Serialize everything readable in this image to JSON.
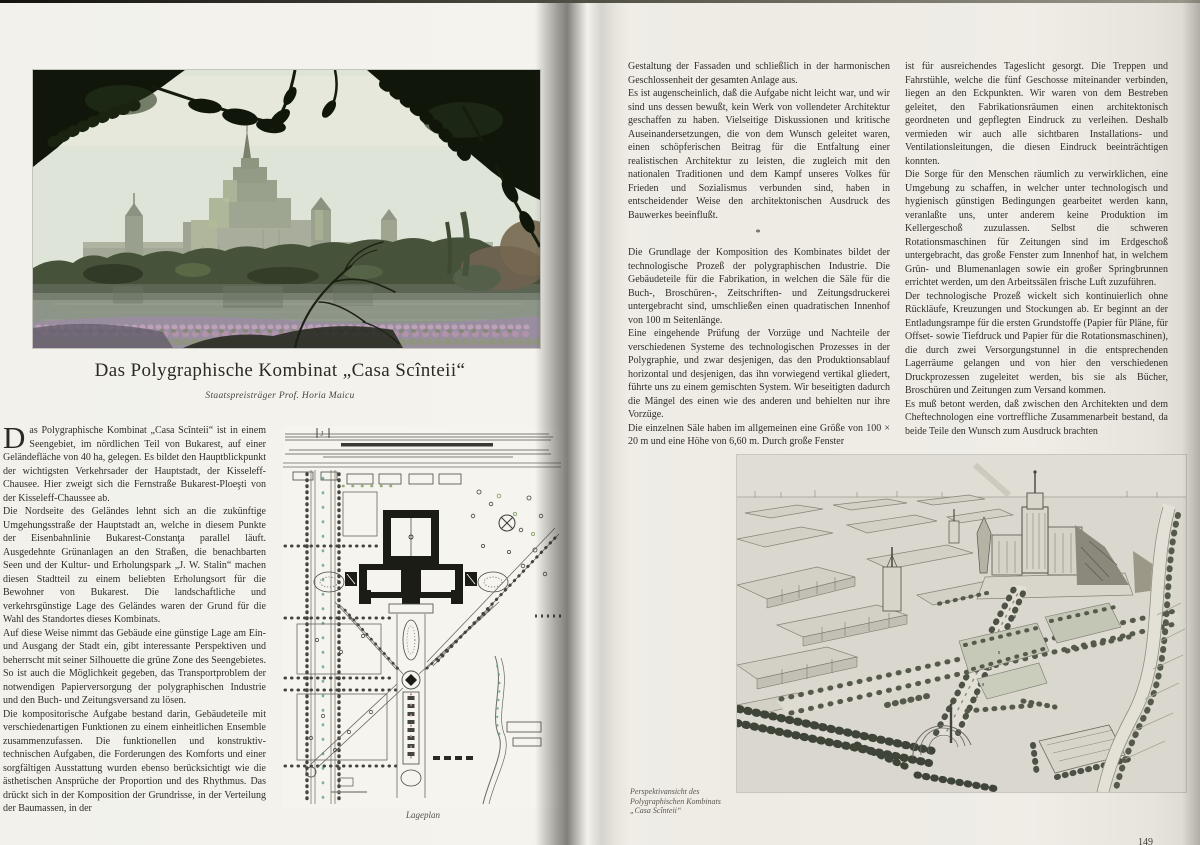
{
  "left": {
    "title": "Das Polygraphische Kombinat „Casa Scînteii“",
    "subtitle": "Staatspreisträger Prof. Horia Maicu",
    "dropcap": "D",
    "p1": "as Polygraphische Kombinat „Casa Scînteii“ ist in einem Seengebiet, im nördlichen Teil von Bukarest, auf einer Geländefläche von 40 ha, gelegen. Es bildet den Hauptblickpunkt der wichtigsten Verkehrsader der Hauptstadt, der Kisseleff-Chausee. Hier zweigt sich die Fernstraße Bukarest-Ploeşti von der Kisseleff-Chaussee ab.",
    "p2": "Die Nordseite des Geländes lehnt sich an die zukünftige Umgehungsstraße der Hauptstadt an, welche in diesem Punkte der Eisenbahnlinie Bukarest-Constanţa parallel läuft. Ausgedehnte Grünanlagen an den Straßen, die benachbarten Seen und der Kultur- und Erholungspark „J. W. Stalin“ machen diesen Stadtteil zu einem beliebten Erholungsort für die Bewohner von Bukarest. Die landschaftliche und verkehrsgünstige Lage des Geländes waren der Grund für die Wahl des Standortes dieses Kombinats.",
    "p3": "Auf diese Weise nimmt das Gebäude eine günstige Lage am Ein- und Ausgang der Stadt ein, gibt interessante Perspektiven und beherrscht mit seiner Silhouette die grüne Zone des Seengebietes. So ist auch die Möglichkeit gegeben, das Transportproblem der notwendigen Papierversorgung der polygraphischen Industrie und den Buch- und Zeitungsversand zu lösen.",
    "p4": "Die kompositorische Aufgabe bestand darin, Gebäudeteile mit verschiedenartigen Funktionen zu einem einheitlichen Ensemble zusammenzufassen. Die funktionellen und konstruktiv-technischen Aufgaben, die Forderungen des Komforts und einer sorgfältigen Ausstattung wurden ebenso berücksichtigt wie die ästhetischen Ansprüche der Proportion und des Rhythmus. Das drückt sich in der Komposition der Grundrisse, in der Verteilung der Baumassen, in der",
    "plan_caption": "Lageplan",
    "plan_mark": "J"
  },
  "right": {
    "c1p1": "Gestaltung der Fassaden und schließlich in der harmonischen Geschlossenheit der gesamten Anlage aus.",
    "c1p2": "Es ist augenscheinlich, daß die Aufgabe nicht leicht war, und wir sind uns dessen bewußt, kein Werk von vollendeter Architektur geschaffen zu haben. Vielseitige Diskussionen und kritische Auseinandersetzungen, die von dem Wunsch geleitet waren, einen schöpferischen Beitrag für die Entfaltung einer realistischen Architektur zu leisten, die zugleich mit den nationalen Traditionen und dem Kampf unseres Volkes für Frieden und Sozialismus verbunden sind, haben in entscheidender Weise den architektonischen Ausdruck des Bauwerkes beeinflußt.",
    "sep": "*",
    "c1p3": "Die Grundlage der Komposition des Kombinates bildet der technologische Prozeß der polygraphischen Industrie. Die Gebäudeteile für die Fabrikation, in welchen die Säle für die Buch-, Broschüren-, Zeitschriften- und Zeitungsdruckerei untergebracht sind, umschließen einen quadratischen Innenhof von 100 m Seitenlänge.",
    "c1p4": "Eine eingehende Prüfung der Vorzüge und Nachteile der verschiedenen Systeme des technologischen Prozesses in der Polygraphie, und zwar desjenigen, das den Produktionsablauf horizontal und desjenigen, das ihn vorwiegend vertikal gliedert, führte uns zu einem gemischten System. Wir beseitigten dadurch die Mängel des einen wie des anderen und behielten nur ihre Vorzüge.",
    "c1p5": "Die einzelnen Säle haben im allgemeinen eine Größe von 100 × 20 m und eine Höhe von 6,60 m. Durch große Fenster",
    "c2p1": "ist für ausreichendes Tageslicht gesorgt. Die Treppen und Fahrstühle, welche die fünf Geschosse miteinander verbinden, liegen an den Eckpunkten. Wir waren von dem Bestreben geleitet, den Fabrikationsräumen einen architektonisch geordneten und gepflegten Eindruck zu verleihen. Deshalb vermieden wir auch alle sichtbaren Installations- und Ventilationsleitungen, die diesen Eindruck beeinträchtigen konnten.",
    "c2p2": "Die Sorge für den Menschen räumlich zu verwirklichen, eine Umgebung zu schaffen, in welcher unter technologisch und hygienisch günstigen Bedingungen gearbeitet werden kann, veranlaßte uns, unter anderem keine Produktion im Kellergeschoß zuzulassen. Selbst die schweren Rotationsmaschinen für Zeitungen sind im Erdgeschoß untergebracht, das große Fenster zum Innenhof hat, in welchem Grün- und Blumenanlagen sowie ein großer Springbrunnen errichtet werden, um den Arbeitssälen frische Luft zuzuführen.",
    "c2p3": "Der technologische Prozeß wickelt sich kontinuierlich ohne Rückläufe, Kreuzungen und Stockungen ab. Er beginnt an der Entladungsrampe für die ersten Grundstoffe (Papier für Pläne, für Offset- sowie Tiefdruck und Papier für die Rotationsmaschinen), die durch zwei Versorgungstunnel in die entsprechenden Lagerräume gelangen und von hier den verschiedenen Druckprozessen zugeleitet werden, bis sie als Bücher, Broschüren und Zeitungen zum Versand kommen.",
    "c2p4": "Es muß betont werden, daß zwischen den Architekten und dem Cheftechnologen eine vortreffliche Zusammenarbeit bestand, da beide Teile den Wunsch zum Ausdruck brachten",
    "caption1": "Perspektivansicht des",
    "caption2": "Polygraphischen Kombinats",
    "caption3": "„Casa Scînteii“",
    "page_number": "149"
  }
}
